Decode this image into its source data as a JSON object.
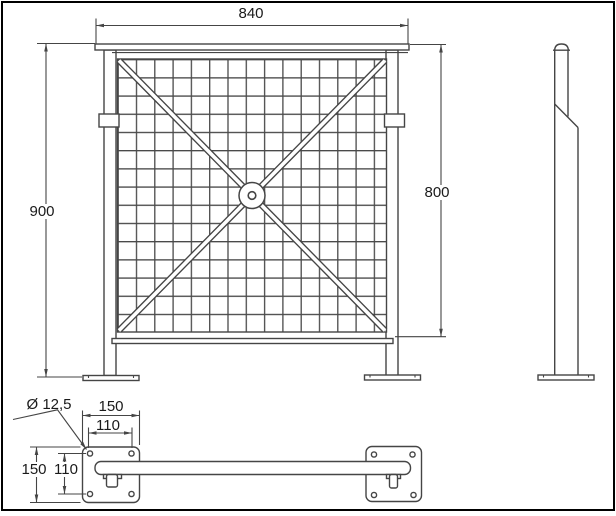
{
  "drawing": {
    "labels": {
      "top_width": "840",
      "left_height": "900",
      "right_height": "800",
      "hole_diameter": "Ø 12,5",
      "plate_width": "150",
      "hole_pitch_h": "110",
      "plate_depth": "150",
      "hole_pitch_v": "110"
    },
    "colors": {
      "line": "#454545",
      "text": "#1a1a1a",
      "background": "#ffffff",
      "frame": "#000000"
    }
  }
}
